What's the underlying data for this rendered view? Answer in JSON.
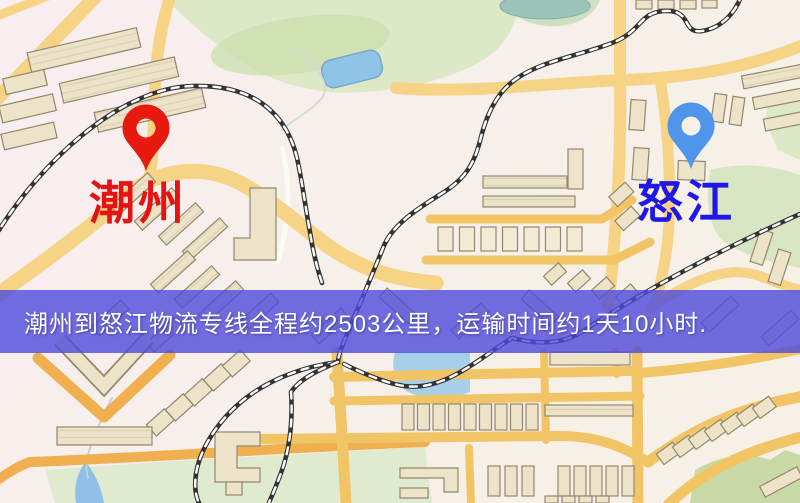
{
  "map": {
    "origin": {
      "label": "潮州",
      "pin_color": "#e8190f",
      "label_color": "#e51313"
    },
    "destination": {
      "label": "怒江",
      "pin_color": "#4f95ea",
      "label_color": "#2017e6"
    }
  },
  "banner": {
    "text": "潮州到怒江物流专线全程约2503公里，运输时间约1天10小时.",
    "background_color": "#4d4adc",
    "text_color": "#ffffff"
  },
  "palette": {
    "road_yellow": "#f6d385",
    "road_grid": "#f1c566",
    "road_orange": "#f0b050",
    "building_fill": "#ece3c9",
    "building_stroke": "#95876e",
    "park_green": "#dce8c6",
    "water_blue": "#8fc4e6",
    "railway_dark": "#333333",
    "background": "#f7efec"
  }
}
